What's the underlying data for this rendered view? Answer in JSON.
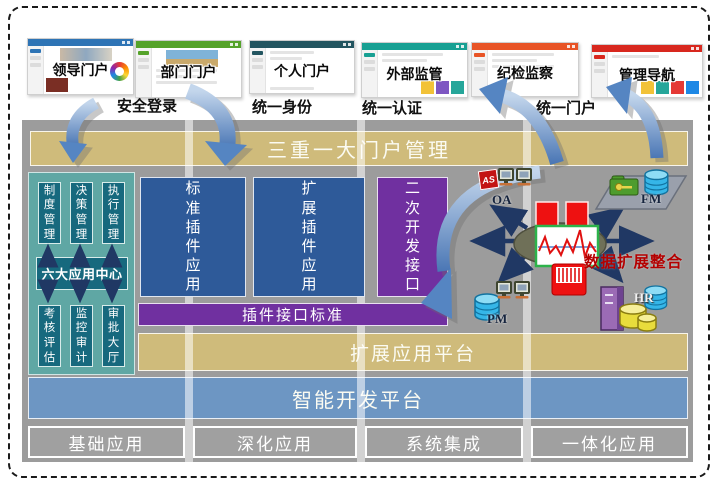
{
  "portals": [
    {
      "label": "领导门户",
      "accent": "#2E74B5"
    },
    {
      "label": "部门门户",
      "accent": "#55A32A"
    },
    {
      "label": "个人门户",
      "accent": "#235560"
    },
    {
      "label": "外部监管",
      "accent": "#18A093"
    },
    {
      "label": "纪检监察",
      "accent": "#E85426"
    },
    {
      "label": "管理导航",
      "accent": "#D8281E"
    }
  ],
  "auth_links": [
    {
      "label": "安全登录"
    },
    {
      "label": "统一身份"
    },
    {
      "label": "统一认证"
    },
    {
      "label": "统一门户"
    }
  ],
  "banner": {
    "label": "三重一大门户管理"
  },
  "app_center": {
    "top_items": [
      {
        "label": "制度管理"
      },
      {
        "label": "决策管理"
      },
      {
        "label": "执行管理"
      }
    ],
    "center_label": "六大应用中心",
    "bottom_items": [
      {
        "label": "考核评估"
      },
      {
        "label": "监控审计"
      },
      {
        "label": "审批大厅"
      }
    ]
  },
  "plugin": {
    "standard_app": "标准插件应用",
    "extend_app": "扩展插件应用",
    "dev_interface": "二次开发接口",
    "interface_standard": "插件接口标准"
  },
  "platforms": {
    "extend": "扩展应用平台",
    "smart_dev": "智能开发平台"
  },
  "bottom_apps": [
    {
      "label": "基础应用"
    },
    {
      "label": "深化应用"
    },
    {
      "label": "系统集成"
    },
    {
      "label": "一体化应用"
    }
  ],
  "integration": {
    "title": "数据扩展整合",
    "as_badge": "AS",
    "systems": [
      {
        "label": "OA"
      },
      {
        "label": "FM"
      },
      {
        "label": "PM"
      },
      {
        "label": "HR"
      }
    ]
  },
  "colors": {
    "panel_gray": "#9C9C9C",
    "banner_tan": "#CFBB7B",
    "plugin_blue": "#2E5A99",
    "purple": "#7030A0",
    "teal_light": "#5FA7A4",
    "teal_dark": "#17697E",
    "platform_blue": "#6D96C3",
    "arrow_navy": "#203864",
    "title_red": "#B40000"
  }
}
